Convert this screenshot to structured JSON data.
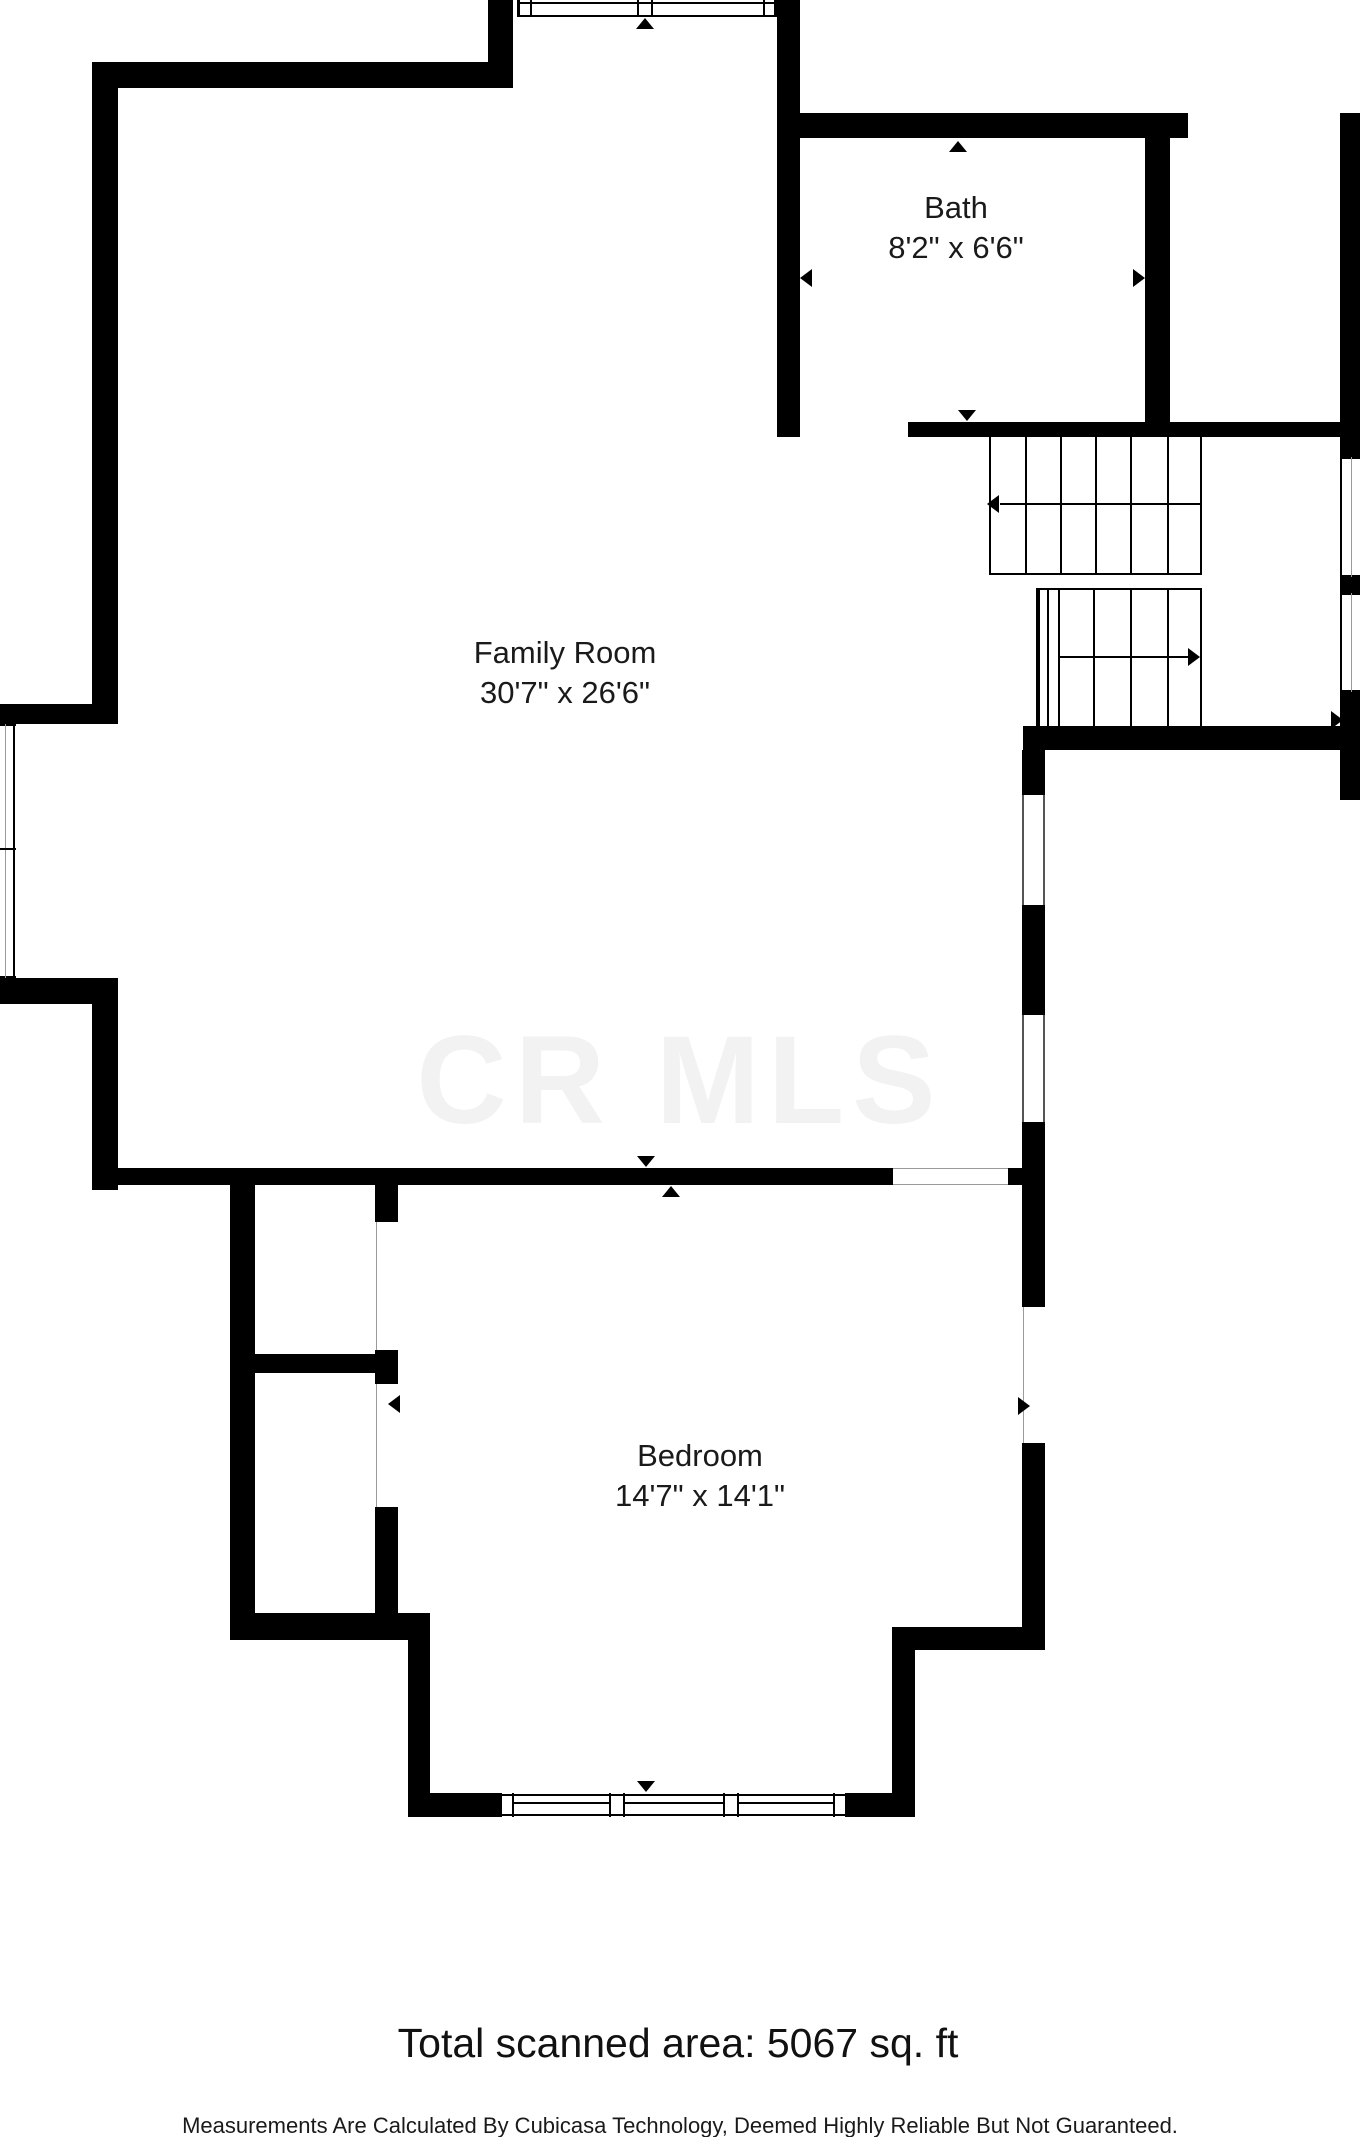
{
  "floorplan": {
    "watermark": "CR MLS",
    "rooms": {
      "bath": {
        "name": "Bath",
        "dims": "8'2\" x 6'6\""
      },
      "family_room": {
        "name": "Family Room",
        "dims": "30'7\" x 26'6\""
      },
      "bedroom": {
        "name": "Bedroom",
        "dims": "14'7\" x 14'1\""
      }
    },
    "footer": {
      "total_area": "Total scanned area: 5067 sq. ft",
      "disclaimer": "Measurements Are Calculated By Cubicasa Technology, Deemed Highly Reliable But Not Guaranteed."
    },
    "colors": {
      "wall": "#000000",
      "text": "#1a1a1a",
      "watermark": "#f2f2f2"
    }
  }
}
